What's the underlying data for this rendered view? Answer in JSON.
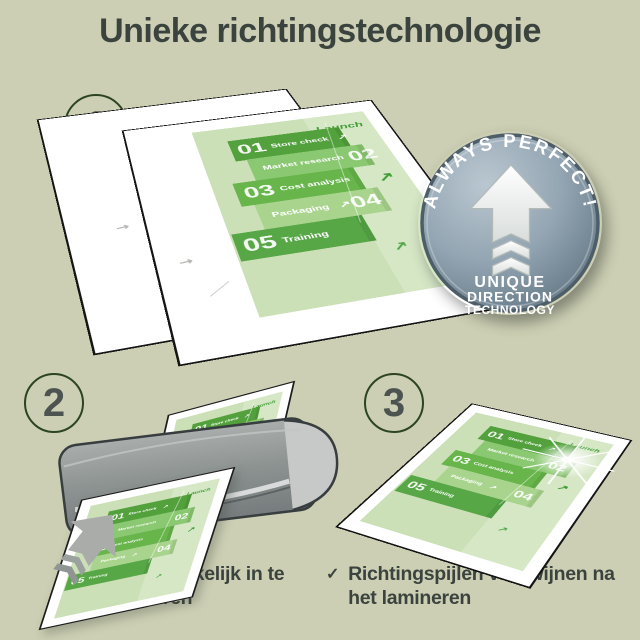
{
  "page": {
    "title": "Unieke richtingstechnologie"
  },
  "steps": {
    "one": "1",
    "two": "2",
    "three": "3"
  },
  "badge": {
    "arc_text": "ALWAYS PERFECT!",
    "line1": "UNIQUE",
    "line2": "DIRECTION",
    "line3": "TECHNOLOGY"
  },
  "doc": {
    "launch": "Launch",
    "items": [
      {
        "num": "01",
        "label": "Store check"
      },
      {
        "num": "02",
        "label": "Market research"
      },
      {
        "num": "03",
        "label": "Cost analysis"
      },
      {
        "num": "04",
        "label": "Packaging"
      },
      {
        "num": "05",
        "label": "Training"
      }
    ]
  },
  "checklist": {
    "item1": {
      "mark": "✓",
      "text": "Gemakkelijk in te voeren"
    },
    "item2": {
      "mark": "✓",
      "text": "Richtingspijlen verdwijnen na het lamineren"
    }
  },
  "icons": {
    "doc_arrow_glyph": "↗"
  },
  "colors": {
    "background": "#cccfb3",
    "text": "#3b433e",
    "doc_page_green": "#cbe0b6",
    "band_greens": [
      "#52a13c",
      "#8bc872",
      "#67b54b",
      "#a9d48e",
      "#57a747"
    ],
    "accent_green": "#3f9e35",
    "badge_blue_gray": "#8499a8",
    "machine_gray": "#8e9492",
    "feed_arrow_gray": "#a9aca9"
  }
}
